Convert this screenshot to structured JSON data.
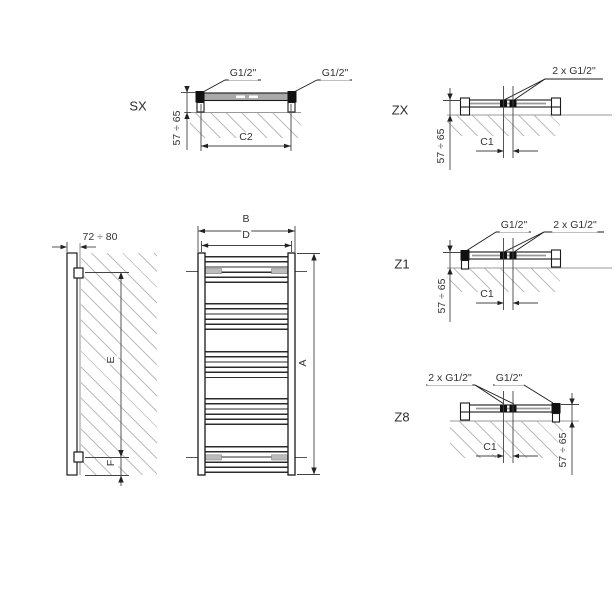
{
  "drawing": {
    "title_hint": "towel radiator dimension drawing",
    "views": {
      "sx": {
        "label": "SX",
        "conn_left": "G1/2\"",
        "conn_right": "G1/2\"",
        "depth_dim": "57 ÷ 65",
        "width_dim": "C2"
      },
      "zx": {
        "label": "ZX",
        "conn_center": "2 x G1/2\"",
        "depth_dim": "57 ÷ 65",
        "center_dim": "C1"
      },
      "z1": {
        "label": "Z1",
        "conn_left": "G1/2\"",
        "conn_center": "2 x G1/2\"",
        "depth_dim": "57 ÷ 65",
        "center_dim": "C1"
      },
      "z8": {
        "label": "Z8",
        "conn_center": "2 x G1/2\"",
        "conn_right": "G1/2\"",
        "depth_dim": "57 ÷ 65",
        "center_dim": "C1"
      },
      "side": {
        "wall_distance_dim": "72 ÷ 80",
        "upper_span_dim": "E",
        "lower_span_dim": "F"
      },
      "front": {
        "overall_width_dim": "B",
        "pipe_spacing_dim": "D",
        "height_dim": "A"
      }
    },
    "colors": {
      "line": "#1a1a1a",
      "hatch": "#bdbdbd",
      "wall_line": "#9a9a9a",
      "bar_fill": "#a9a9a9",
      "text": "#333333"
    }
  }
}
